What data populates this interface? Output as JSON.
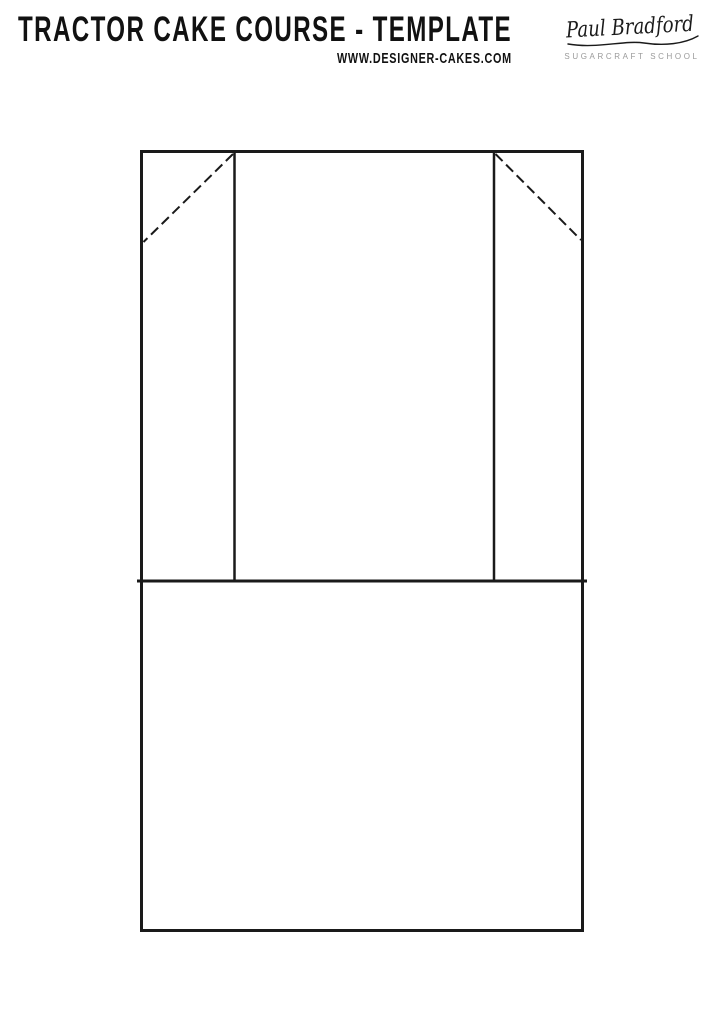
{
  "header": {
    "title": "TRACTOR CAKE COURSE - TEMPLATE",
    "website": "WWW.DESIGNER-CAKES.COM",
    "logo": {
      "signature_name": "Paul Bradford",
      "subtitle": "SUGARCRAFT SCHOOL"
    }
  },
  "colors": {
    "background": "#ffffff",
    "ink": "#111111",
    "diagram_stroke": "#1a1a1a",
    "logo_subtitle_gray": "#9a9a9a"
  }
}
